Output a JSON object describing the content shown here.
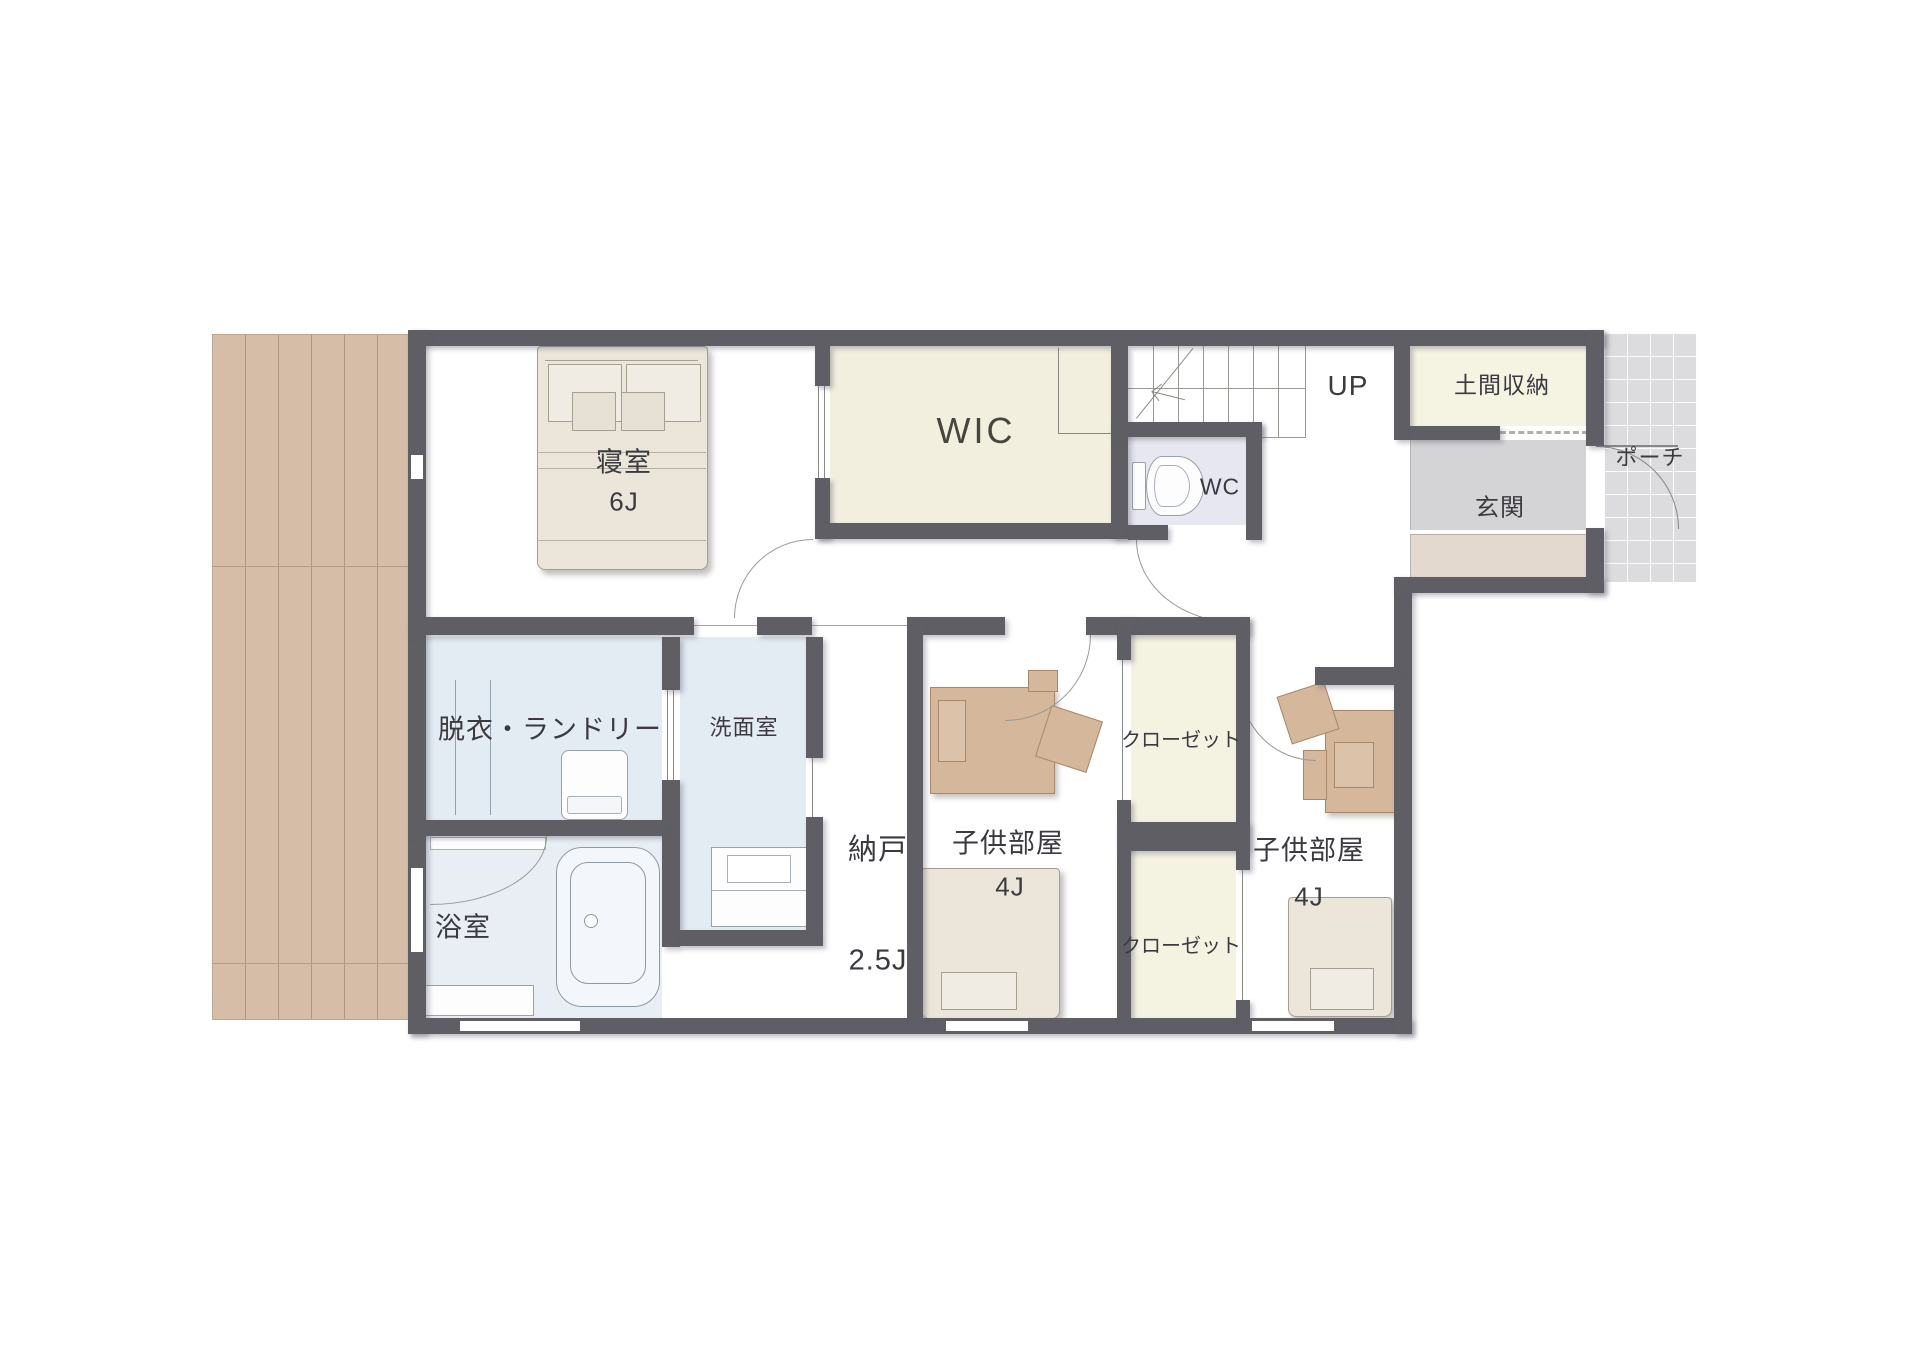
{
  "rooms": {
    "bedroom": {
      "name": "寝室",
      "size": "6J"
    },
    "wic": {
      "name": "WIC"
    },
    "stairs_up": {
      "name": "UP"
    },
    "doma_storage": {
      "name": "土間収納"
    },
    "porch": {
      "name": "ポーチ"
    },
    "entrance": {
      "name": "玄関"
    },
    "toilet": {
      "name": "WC"
    },
    "laundry": {
      "name": "脱衣・ランドリー"
    },
    "washroom": {
      "name": "洗面室"
    },
    "bathroom": {
      "name": "浴室"
    },
    "storage_room": {
      "name": "納戸",
      "size": "2.5J"
    },
    "kids_room_left": {
      "name": "子供部屋",
      "size": "4J"
    },
    "closet_upper": {
      "name": "クローゼット"
    },
    "closet_lower": {
      "name": "クローゼット"
    },
    "kids_room_right": {
      "name": "子供部屋",
      "size": "4J"
    }
  },
  "colors": {
    "wall": "#5e5e64",
    "deck": "#d6bda7",
    "closet_floor": "#f3f1df",
    "wet_area_floor": "#e3ebf3",
    "bath_floor": "#e9eef5",
    "wc_floor": "#e7e7f1",
    "entrance_floor": "#d4d4d6",
    "entrance_step": "#e3d9cf",
    "porch_floor": "#dcdcde",
    "furniture_wood": "#d5b79b",
    "bedding": "#ebe5da"
  }
}
